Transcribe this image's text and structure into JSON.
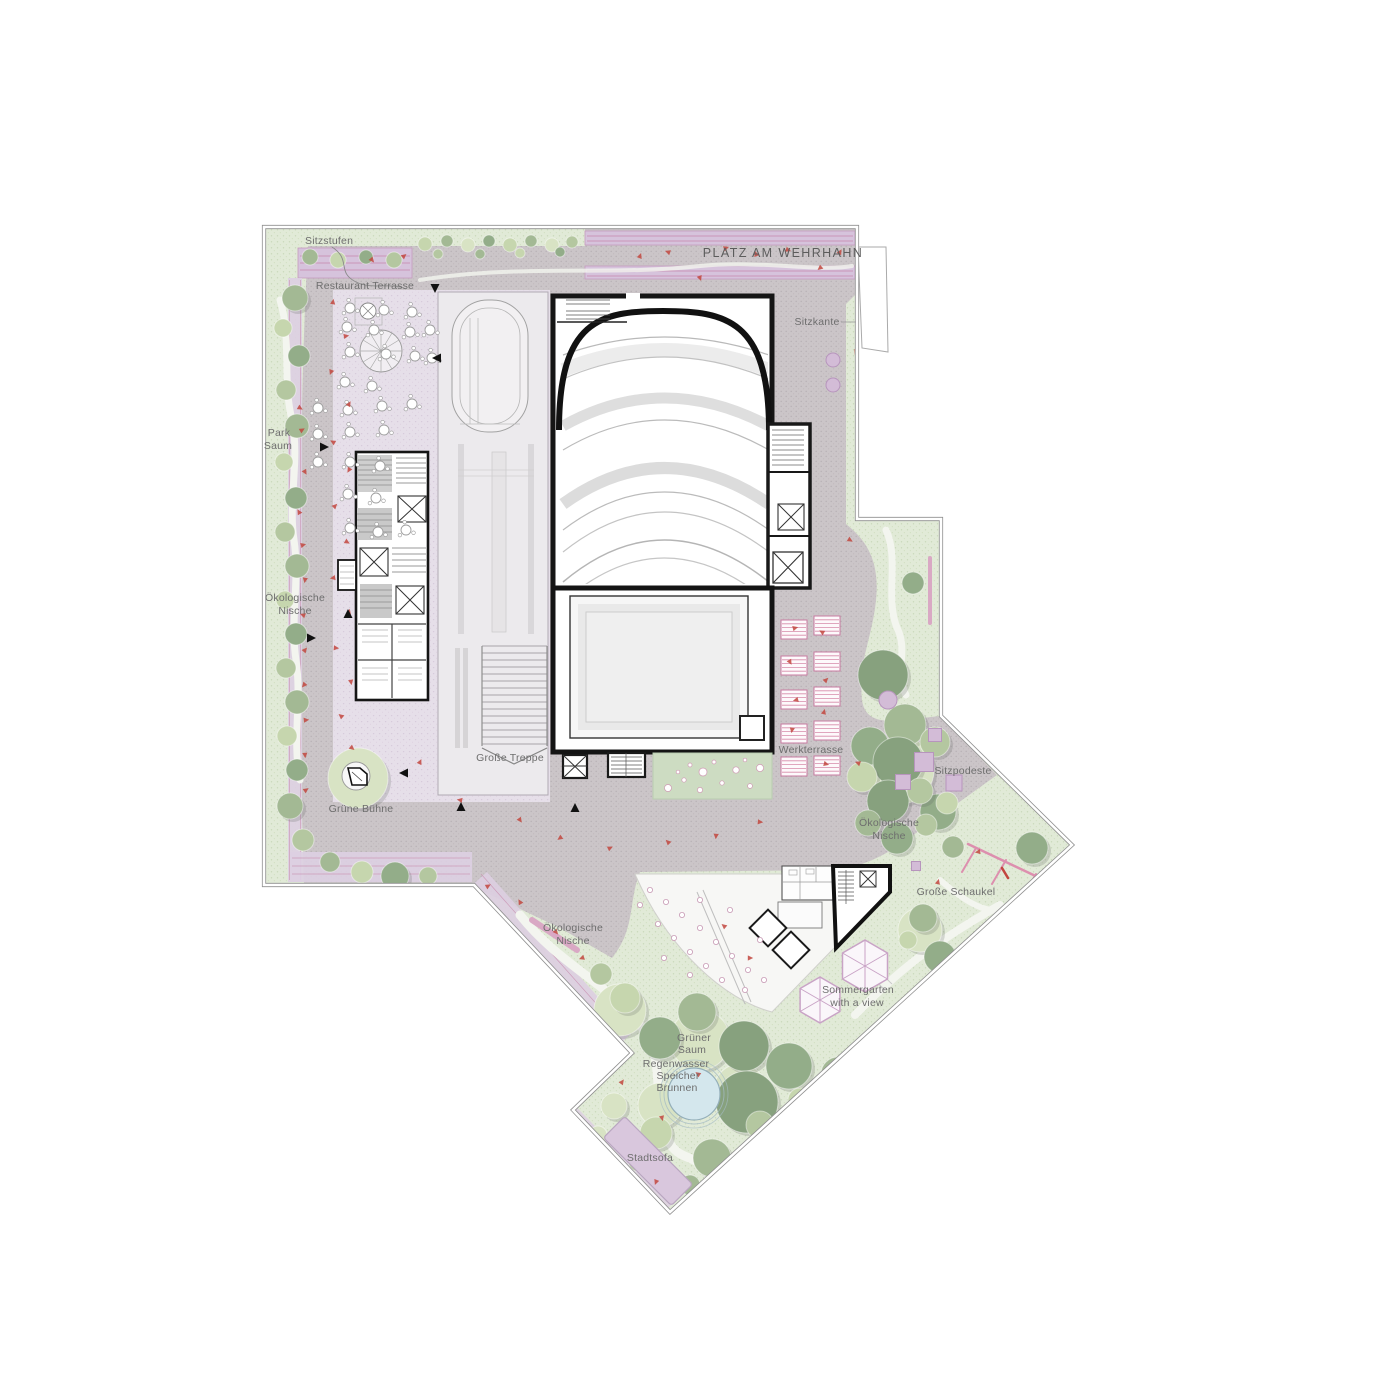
{
  "plan": {
    "title": "PLATZ AM WEHRHAHN",
    "labels": {
      "sitzstufen": "Sitzstufen",
      "platz": "PLATZ AM WEHRHAHN",
      "restaurant": "Restaurant Terrasse",
      "sitzkante": "Sitzkante",
      "park1": "Park",
      "park2": "Saum",
      "oekoL1": "Ökologische",
      "oekoL2": "Nische",
      "treppe": "Große Treppe",
      "buehne": "Grüne Bühne",
      "werk": "Werkterrasse",
      "oekoR1": "Ökologische",
      "oekoR2": "Nische",
      "podeste": "Sitzpodeste",
      "schaukel": "Große Schaukel",
      "oekoB1": "Ökologische",
      "oekoB2": "Nische",
      "sommer1": "Sommergarten",
      "sommer2": "with a view",
      "saum1": "Grüner",
      "saum2": "Saum",
      "regen1": "Regenwasser",
      "regen2": "Speicher",
      "regen3": "Brunnen",
      "stadtsofa": "Stadtsofa"
    },
    "palette": {
      "plaza": "#cbc5c8",
      "plaza_dot": "#b9b1b6",
      "green": "#e1ead7",
      "green_dot": "#c8d7b8",
      "lavender": "#e6dfe9",
      "lavender_dot": "#d6c9da",
      "band_purple": "#d6c3dc",
      "band_line": "#c886ab",
      "wall_black": "#151515",
      "building_gray": "#ececec",
      "accent_pink": "#d4739b",
      "red_figure": "#c2463e",
      "water": "#d4e7ed",
      "outline_gray": "#8f8f8f",
      "tree_greens": [
        "#87a17e",
        "#93ad89",
        "#a3b994",
        "#b4c7a0",
        "#c6d6ae",
        "#d8e3c4"
      ]
    },
    "trees": [
      [
        358,
        778,
        30,
        5
      ],
      [
        620,
        1010,
        26,
        5
      ],
      [
        700,
        1040,
        30,
        5
      ],
      [
        740,
        1090,
        26,
        5
      ],
      [
        900,
        770,
        34,
        5
      ],
      [
        920,
        930,
        22,
        5
      ],
      [
        660,
        1105,
        22,
        5
      ],
      [
        295,
        298,
        13,
        2
      ],
      [
        283,
        328,
        9,
        4
      ],
      [
        299,
        356,
        11,
        1
      ],
      [
        286,
        390,
        10,
        3
      ],
      [
        297,
        426,
        12,
        2
      ],
      [
        284,
        462,
        9,
        4
      ],
      [
        296,
        498,
        11,
        1
      ],
      [
        285,
        532,
        10,
        3
      ],
      [
        297,
        566,
        12,
        2
      ],
      [
        285,
        600,
        9,
        4
      ],
      [
        296,
        634,
        11,
        1
      ],
      [
        286,
        668,
        10,
        3
      ],
      [
        297,
        702,
        12,
        2
      ],
      [
        287,
        736,
        10,
        4
      ],
      [
        297,
        770,
        11,
        1
      ],
      [
        290,
        806,
        13,
        2
      ],
      [
        303,
        840,
        11,
        3
      ],
      [
        330,
        862,
        10,
        2
      ],
      [
        362,
        872,
        11,
        4
      ],
      [
        395,
        876,
        14,
        1
      ],
      [
        428,
        876,
        9,
        3
      ],
      [
        425,
        244,
        7,
        4
      ],
      [
        447,
        241,
        6,
        2
      ],
      [
        468,
        245,
        7,
        5
      ],
      [
        489,
        241,
        6,
        1
      ],
      [
        510,
        245,
        7,
        4
      ],
      [
        531,
        241,
        6,
        2
      ],
      [
        552,
        245,
        7,
        5
      ],
      [
        572,
        242,
        6,
        3
      ],
      [
        438,
        254,
        5,
        3
      ],
      [
        480,
        254,
        5,
        2
      ],
      [
        520,
        253,
        5,
        4
      ],
      [
        560,
        252,
        5,
        1
      ],
      [
        310,
        257,
        8,
        2
      ],
      [
        338,
        260,
        8,
        4
      ],
      [
        366,
        257,
        7,
        1
      ],
      [
        394,
        260,
        8,
        3
      ],
      [
        913,
        583,
        11,
        1
      ],
      [
        883,
        675,
        25,
        0
      ],
      [
        938,
        812,
        18,
        1
      ],
      [
        905,
        725,
        21,
        2
      ],
      [
        935,
        742,
        15,
        3
      ],
      [
        870,
        746,
        19,
        1
      ],
      [
        898,
        762,
        25,
        0
      ],
      [
        862,
        777,
        15,
        4
      ],
      [
        888,
        801,
        21,
        0
      ],
      [
        920,
        791,
        13,
        3
      ],
      [
        947,
        803,
        11,
        4
      ],
      [
        868,
        823,
        13,
        2
      ],
      [
        897,
        838,
        16,
        1
      ],
      [
        926,
        825,
        11,
        3
      ],
      [
        953,
        847,
        11,
        2
      ],
      [
        1032,
        848,
        16,
        1
      ],
      [
        923,
        918,
        14,
        2
      ],
      [
        940,
        957,
        16,
        1
      ],
      [
        908,
        940,
        9,
        4
      ],
      [
        625,
        998,
        15,
        4
      ],
      [
        601,
        974,
        11,
        3
      ],
      [
        660,
        1038,
        21,
        1
      ],
      [
        697,
        1012,
        19,
        2
      ],
      [
        744,
        1046,
        25,
        0
      ],
      [
        789,
        1066,
        23,
        1
      ],
      [
        747,
        1102,
        31,
        0
      ],
      [
        712,
        1158,
        19,
        2
      ],
      [
        656,
        1133,
        16,
        4
      ],
      [
        614,
        1106,
        13,
        5
      ],
      [
        587,
        1072,
        11,
        4
      ],
      [
        838,
        1074,
        17,
        2
      ],
      [
        874,
        1044,
        13,
        3
      ],
      [
        640,
        1160,
        12,
        3
      ],
      [
        690,
        1185,
        10,
        2
      ],
      [
        570,
        1040,
        10,
        5
      ],
      [
        545,
        1005,
        12,
        4
      ],
      [
        598,
        1135,
        9,
        5
      ],
      [
        760,
        1125,
        14,
        3
      ],
      [
        800,
        1100,
        12,
        4
      ]
    ],
    "figures": [
      [
        333,
        302,
        10
      ],
      [
        346,
        336,
        80
      ],
      [
        331,
        372,
        200
      ],
      [
        349,
        404,
        30
      ],
      [
        300,
        408,
        120
      ],
      [
        302,
        430,
        60
      ],
      [
        333,
        442,
        300
      ],
      [
        305,
        472,
        150
      ],
      [
        349,
        470,
        210
      ],
      [
        335,
        506,
        45
      ],
      [
        299,
        512,
        330
      ],
      [
        347,
        542,
        120
      ],
      [
        303,
        545,
        75
      ],
      [
        333,
        578,
        260
      ],
      [
        349,
        612,
        15
      ],
      [
        305,
        580,
        190
      ],
      [
        336,
        648,
        95
      ],
      [
        303,
        615,
        290
      ],
      [
        351,
        682,
        170
      ],
      [
        305,
        650,
        40
      ],
      [
        341,
        716,
        310
      ],
      [
        304,
        685,
        220
      ],
      [
        352,
        748,
        130
      ],
      [
        306,
        720,
        85
      ],
      [
        420,
        762,
        25
      ],
      [
        305,
        755,
        175
      ],
      [
        460,
        800,
        280
      ],
      [
        306,
        790,
        55
      ],
      [
        520,
        820,
        145
      ],
      [
        560,
        838,
        235
      ],
      [
        610,
        848,
        65
      ],
      [
        668,
        842,
        315
      ],
      [
        716,
        836,
        185
      ],
      [
        760,
        822,
        95
      ],
      [
        640,
        256,
        20
      ],
      [
        668,
        252,
        290
      ],
      [
        700,
        278,
        160
      ],
      [
        726,
        248,
        70
      ],
      [
        756,
        254,
        340
      ],
      [
        788,
        250,
        110
      ],
      [
        820,
        268,
        230
      ],
      [
        840,
        252,
        30
      ],
      [
        856,
        352,
        200
      ],
      [
        850,
        540,
        120
      ],
      [
        795,
        628,
        75
      ],
      [
        822,
        632,
        300
      ],
      [
        790,
        662,
        150
      ],
      [
        826,
        680,
        45
      ],
      [
        796,
        700,
        255
      ],
      [
        824,
        712,
        15
      ],
      [
        792,
        730,
        190
      ],
      [
        826,
        764,
        105
      ],
      [
        858,
        763,
        290
      ],
      [
        488,
        886,
        60
      ],
      [
        520,
        902,
        330
      ],
      [
        556,
        932,
        140
      ],
      [
        582,
        958,
        250
      ],
      [
        622,
        1082,
        35
      ],
      [
        662,
        1118,
        165
      ],
      [
        698,
        1074,
        305
      ],
      [
        604,
        1158,
        80
      ],
      [
        656,
        1182,
        200
      ],
      [
        902,
        1012,
        120
      ],
      [
        938,
        882,
        15
      ],
      [
        978,
        852,
        260
      ],
      [
        750,
        958,
        90
      ],
      [
        724,
        926,
        310
      ],
      [
        372,
        260,
        140
      ],
      [
        404,
        256,
        50
      ]
    ],
    "restaurant_tables": [
      [
        350,
        308
      ],
      [
        384,
        310
      ],
      [
        412,
        312
      ],
      [
        347,
        327
      ],
      [
        374,
        330
      ],
      [
        410,
        332
      ],
      [
        430,
        330
      ],
      [
        350,
        352
      ],
      [
        386,
        354
      ],
      [
        415,
        356
      ],
      [
        432,
        358
      ],
      [
        345,
        382
      ],
      [
        372,
        386
      ],
      [
        348,
        410
      ],
      [
        382,
        406
      ],
      [
        412,
        404
      ],
      [
        318,
        408
      ],
      [
        350,
        432
      ],
      [
        384,
        430
      ],
      [
        318,
        434
      ],
      [
        350,
        462
      ],
      [
        380,
        466
      ],
      [
        318,
        462
      ],
      [
        348,
        494
      ],
      [
        376,
        498
      ],
      [
        350,
        528
      ],
      [
        378,
        532
      ],
      [
        406,
        530
      ]
    ],
    "terrace_circles": [
      [
        650,
        890
      ],
      [
        666,
        902
      ],
      [
        682,
        915
      ],
      [
        700,
        928
      ],
      [
        716,
        942
      ],
      [
        732,
        956
      ],
      [
        748,
        970
      ],
      [
        658,
        924
      ],
      [
        674,
        938
      ],
      [
        690,
        952
      ],
      [
        706,
        966
      ],
      [
        722,
        980
      ],
      [
        745,
        990
      ],
      [
        640,
        905
      ],
      [
        700,
        900
      ],
      [
        730,
        910
      ],
      [
        760,
        940
      ],
      [
        764,
        980
      ],
      [
        690,
        975
      ],
      [
        664,
        958
      ]
    ],
    "planters": [
      [
        781,
        620
      ],
      [
        781,
        656
      ],
      [
        781,
        690
      ],
      [
        781,
        724
      ],
      [
        781,
        757
      ],
      [
        814,
        616
      ],
      [
        814,
        652
      ],
      [
        814,
        687
      ],
      [
        814,
        721
      ],
      [
        814,
        756
      ]
    ],
    "purple_squares": [
      [
        935,
        735,
        13
      ],
      [
        924,
        762,
        19
      ],
      [
        903,
        782,
        15
      ],
      [
        954,
        783,
        16
      ],
      [
        916,
        866,
        9
      ]
    ],
    "purple_dots": [
      [
        833,
        360,
        7
      ],
      [
        833,
        385,
        7
      ],
      [
        888,
        700,
        9
      ]
    ],
    "umbrellas": [
      [
        865,
        966,
        26
      ],
      [
        820,
        1000,
        23
      ]
    ],
    "arrows": [
      [
        435,
        288,
        180
      ],
      [
        437,
        358,
        270
      ],
      [
        324,
        447,
        90
      ],
      [
        348,
        614,
        0
      ],
      [
        311,
        638,
        90
      ],
      [
        404,
        773,
        270
      ],
      [
        461,
        807,
        0
      ],
      [
        575,
        808,
        0
      ]
    ]
  }
}
